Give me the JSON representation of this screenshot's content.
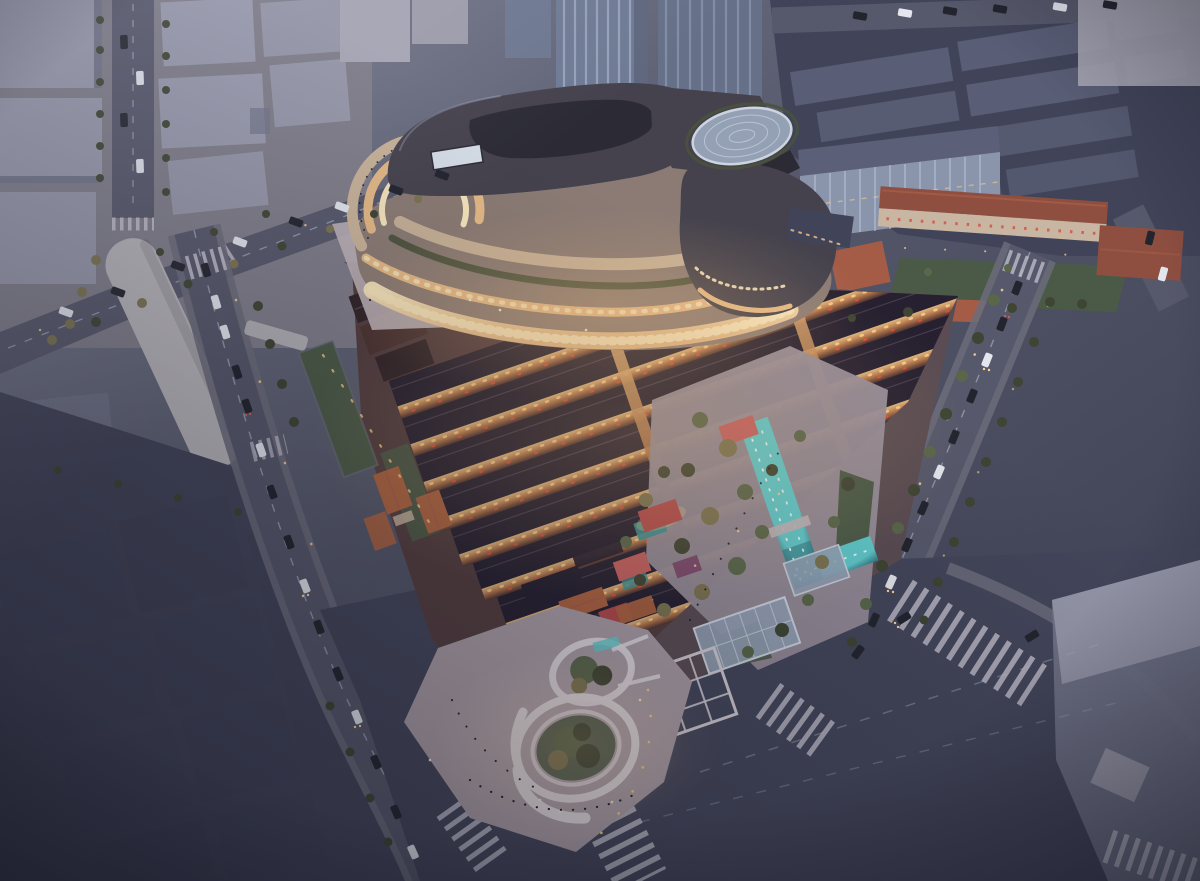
{
  "scene": {
    "description": "Dusk aerial rendering of a mixed-use urban development: a curved terraced shopping mall with glowing facades at the north, rows of traditional dark-roofed lane houses with lantern-lit alleys in the center, a landscaped garden with a turquoise water channel and small pavilions to the east, and a circular pavilion plaza at the southern street corner, all surrounded by tree-lined city streets with traffic",
    "time_of_day": "dusk"
  },
  "palette": {
    "bg_top": "#7e8294",
    "bg_mid": "#545769",
    "bg_dark": "#393c4f",
    "nw_block_top": "#989aad",
    "nw_block_side": "#717488",
    "nw_ground": "#7f7d89",
    "pale_tower": "#a6a5b3",
    "canopy": "#b7b5b9",
    "road": "#56586b",
    "road_dark": "#43455a",
    "sidewalk": "#6b6c7b",
    "lane_mark": "#a7abbc",
    "crosswalk": "#c4c1ce",
    "car_white": "#e3e6ed",
    "car_dark": "#22242e",
    "headlight": "#ffd98e",
    "taillight": "#e25849",
    "tree": "#3f4533",
    "tree_lit": "#7b7350",
    "tree_green": "#59664a",
    "lawn": "#4b5a47",
    "ne_shed_top": "#5b5f77",
    "ne_shed_side": "#414459",
    "glass_face": "#8a95ac",
    "glass_mullion": "#b5c0d3",
    "tower_glass": "#6f7a94",
    "tower_stripe": "#a2aec6",
    "mall_body": "#8b7b74",
    "mall_roof": "#45424d",
    "mall_roof_dark": "#2c2b35",
    "mall_tan": "#c9b399",
    "mall_terrace": "#e4b986",
    "mall_shop": "#f5e4bd",
    "mall_green": "#49523c",
    "screen": "#d5dde6",
    "heritage_roof": "#8e4f40",
    "heritage_roof2": "#a55c47",
    "heritage_wall": "#c9b6a2",
    "window_red": "#d0584a",
    "shiku_roof": "#262030",
    "shiku_ridge": "#4d4254",
    "lane_warm": "#b0744b",
    "lane_shadow": "#4c3230",
    "window_glow": "#f6c987",
    "lantern": "#e0503a",
    "orange_roof": "#ab6240",
    "brick": "#4a3331",
    "brick_roof": "#2f2328",
    "garden_ground": "#968c98",
    "pool": "#5fc9cb",
    "pool_deep": "#2a6e79",
    "pool_dot": "#ecfdfd",
    "teal_roof": "#3d9093",
    "pav_red": "#b64c4c",
    "pav_pink": "#c4605f",
    "pav_purple": "#7c4a6e",
    "plaza": "#a89ba4",
    "plaza_light": "#beb2b9",
    "ring_white": "#ded8de",
    "trellis": "#d0cad3",
    "people_dark": "#1c1d26",
    "people_lit": "#f3e6c8",
    "lamp": "#f7cd8a",
    "glow_warm": "#f2bd7e",
    "site_base": "#5a4c52",
    "canopy_glass": "#94a1b5",
    "canopy_frame": "#ccd4e0"
  }
}
